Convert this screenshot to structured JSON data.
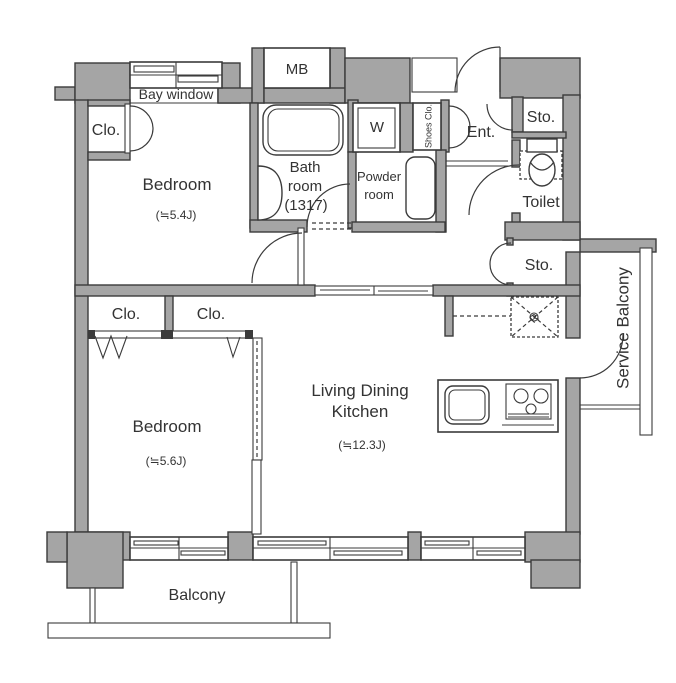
{
  "rooms": {
    "bay_window": "Bay window",
    "closet_bedroom1": "Clo.",
    "bedroom1_name": "Bedroom",
    "bedroom1_area": "(≒5.4J)",
    "meter_box": "MB",
    "bath_line1": "Bath",
    "bath_line2": "room",
    "bath_line3": "(1317)",
    "washer": "W",
    "powder_line1": "Powder",
    "powder_line2": "room",
    "shoes_closet": "Shoes Clo.",
    "entrance": "Ent.",
    "storage_top": "Sto.",
    "toilet": "Toilet",
    "storage_mid": "Sto.",
    "service_balcony": "Service Balcony",
    "closet1": "Clo.",
    "closet2": "Clo.",
    "bedroom2_name": "Bedroom",
    "bedroom2_area": "(≒5.6J)",
    "ldk_line1": "Living Dining",
    "ldk_line2": "Kitchen",
    "ldk_area": "(≒12.3J)",
    "refrigerator": "R",
    "balcony": "Balcony"
  },
  "colors": {
    "wall": "#a5a5a5",
    "outline": "#3b3b3b",
    "text": "#333333",
    "background": "#ffffff"
  }
}
